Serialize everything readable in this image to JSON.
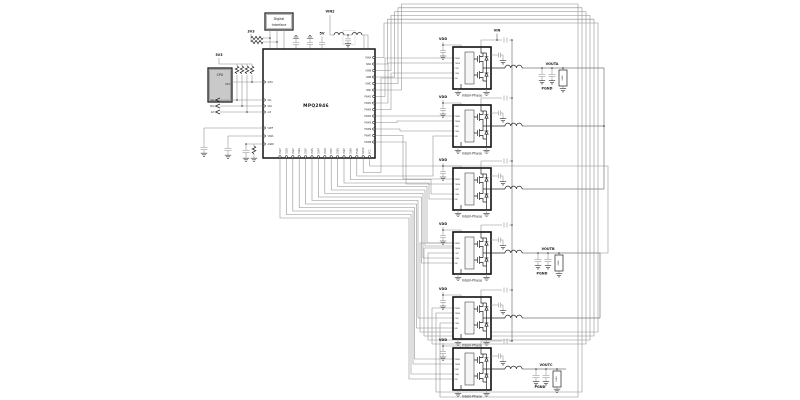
{
  "schematic": {
    "ic": {
      "part": "MPQ2946",
      "pins": {
        "left": [
          "GPIO",
          "SCL",
          "SDA",
          "ALT",
          "VREF",
          "VSNS",
          "AGND"
        ],
        "right": [
          "VSNA",
          "ISNA",
          "VSNB",
          "ISNB",
          "VSNC",
          "ISNC",
          "PWM1",
          "PWM2",
          "PWM3",
          "PWM4",
          "PWM5",
          "PWM6",
          "PWM7",
          "PWM8"
        ],
        "bottom": [
          "CS1P",
          "CS1N",
          "CS2P",
          "CS2N",
          "CS3P",
          "CS3N",
          "CS4P",
          "CS4N",
          "CS5P",
          "CS5N",
          "CS6P",
          "CS6N",
          "TSNS",
          "AGND",
          "VCC"
        ]
      }
    },
    "cpu": {
      "label": "CPU",
      "pin_label": "GPIO"
    },
    "digital_interface": {
      "line1": "Digital",
      "line2": "Interface"
    },
    "flags": [
      "SCL",
      "SDA",
      "ALT"
    ],
    "nets": {
      "vin2": "VIN2",
      "vin": "VIN",
      "v3a": "3V3",
      "v3b": "3V3",
      "v5": "5V"
    },
    "module": {
      "vdd": "VDD",
      "label": "Intelli-Phase",
      "pins": [
        "PWM",
        "TSNS",
        "CSP",
        "CSN",
        "EN"
      ]
    },
    "outputs": {
      "a": "VOUTA",
      "b": "VOUTB",
      "c": "VOUTC",
      "pgnd": "PGND",
      "load": "LOAD"
    },
    "colors": {
      "wire": "#8a8a8a",
      "component": "#141414",
      "cpu_fill": "#c9c9c9"
    }
  }
}
